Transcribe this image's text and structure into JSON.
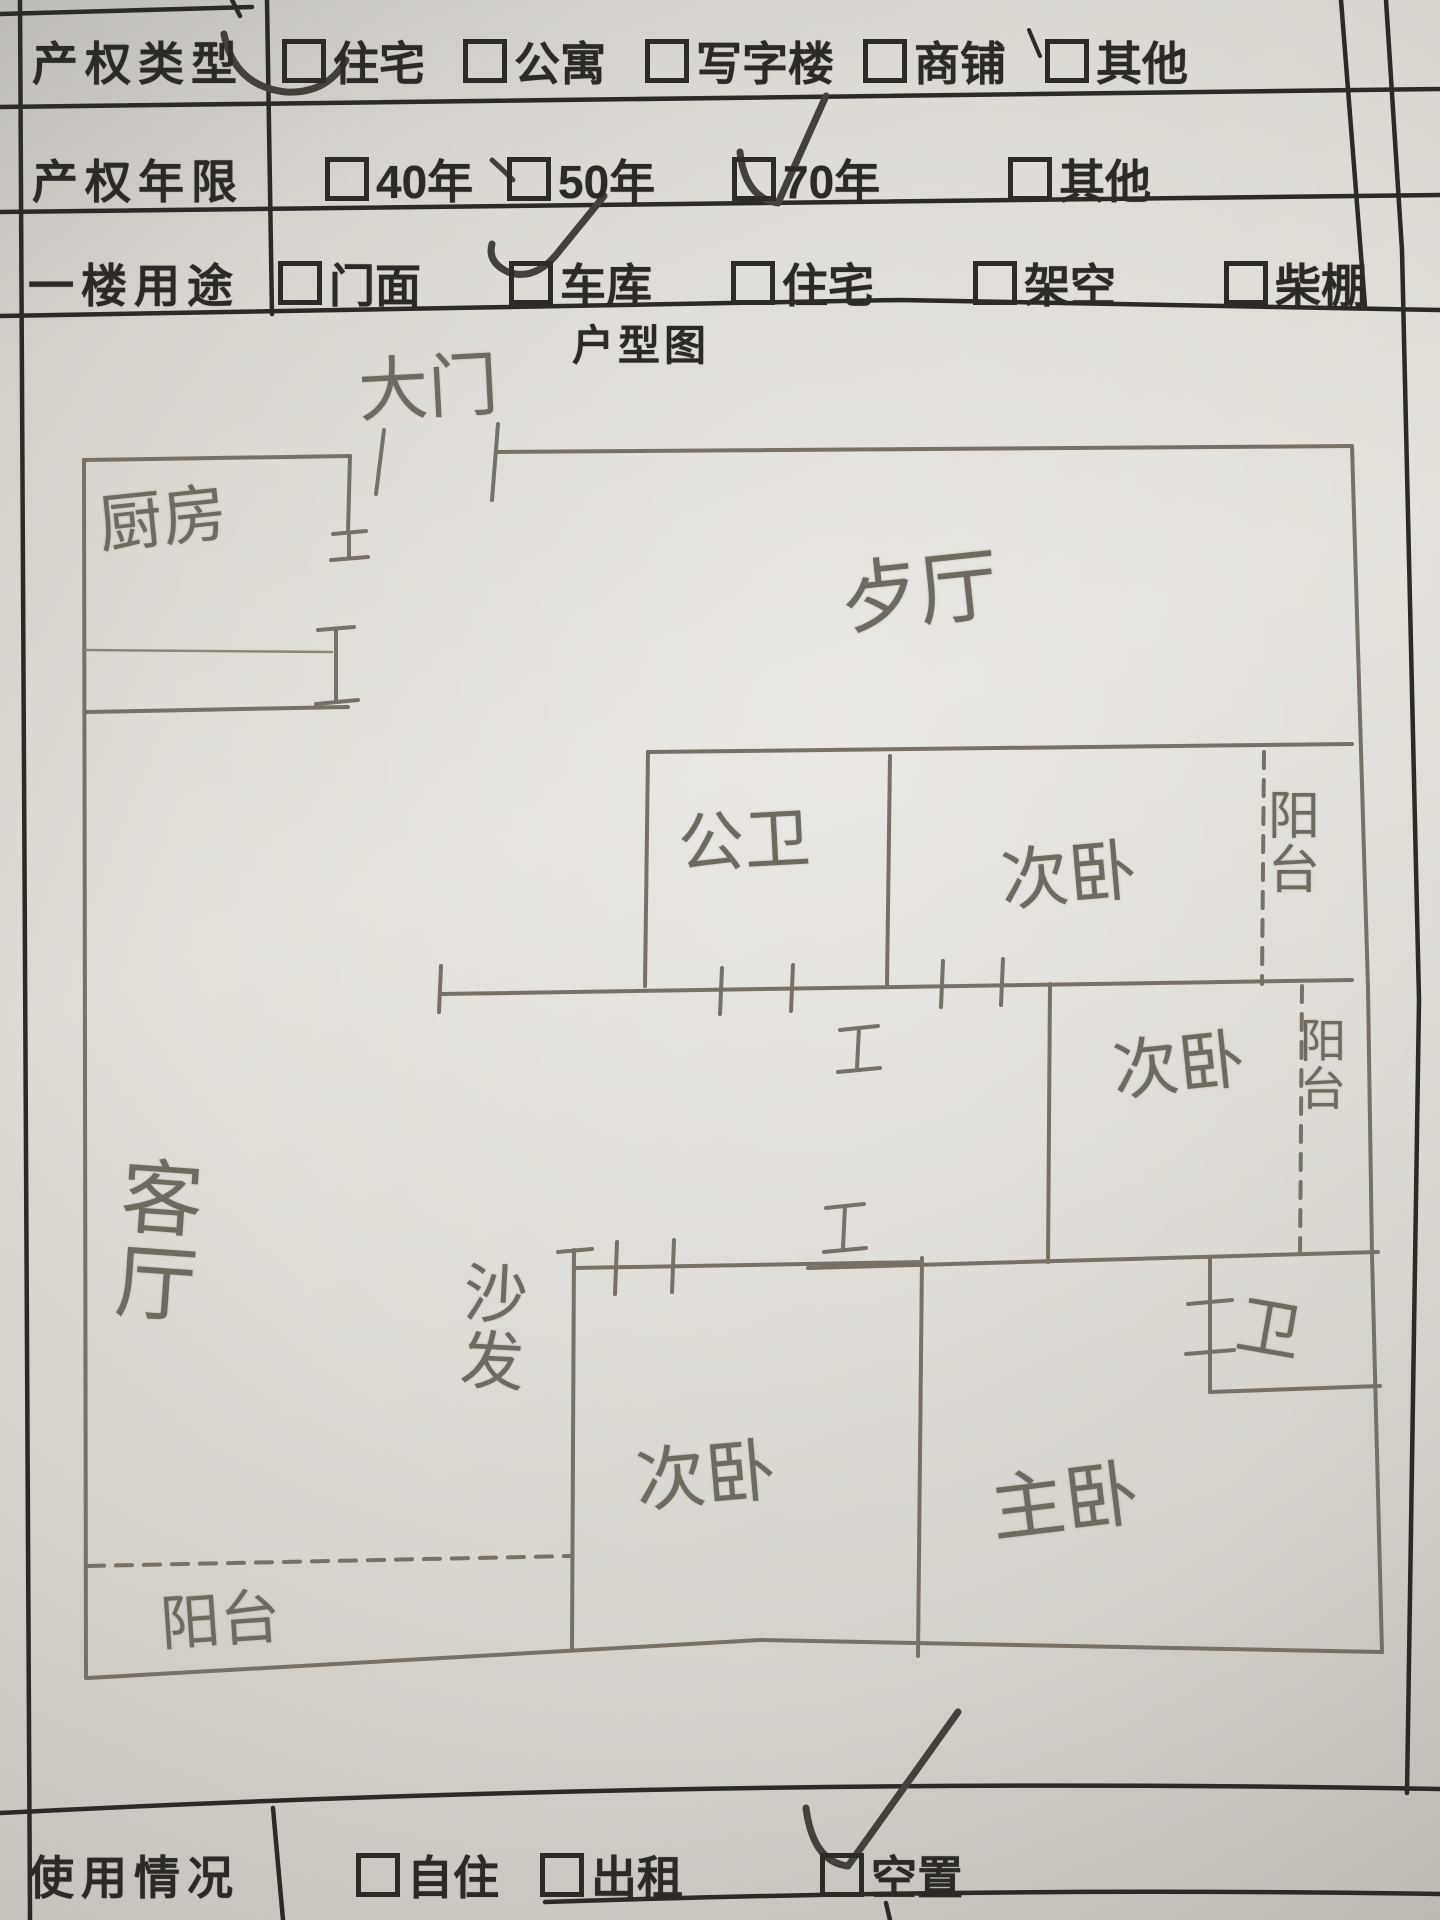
{
  "table": {
    "rows": [
      {
        "label": "产权类型",
        "options": [
          {
            "label": "住宅",
            "marked": true
          },
          {
            "label": "公寓",
            "marked": false
          },
          {
            "label": "写字楼",
            "marked": false
          },
          {
            "label": "商铺",
            "marked": false
          },
          {
            "label": "其他",
            "marked": false
          }
        ]
      },
      {
        "label": "产权年限",
        "options": [
          {
            "label": "40年",
            "marked": false
          },
          {
            "label": "50年",
            "marked": false
          },
          {
            "label": "70年",
            "marked": true
          },
          {
            "label": "其他",
            "marked": false
          }
        ]
      },
      {
        "label": "一楼用途",
        "options": [
          {
            "label": "门面",
            "marked": false
          },
          {
            "label": "车库",
            "marked": true
          },
          {
            "label": "住宅",
            "marked": false
          },
          {
            "label": "架空",
            "marked": false
          },
          {
            "label": "柴棚",
            "marked": false
          }
        ]
      },
      {
        "label": "使用情况",
        "options": [
          {
            "label": "自住",
            "marked": false
          },
          {
            "label": "出租",
            "marked": false
          },
          {
            "label": "空置",
            "marked": true
          }
        ]
      }
    ]
  },
  "floor_plan": {
    "title": "户型图",
    "rooms": {
      "entrance": "大门",
      "kitchen": "厨房",
      "dining": "歺厅",
      "public_bathroom": "公卫",
      "bedroom_top": "次卧",
      "balcony_top": "阳台",
      "bedroom_middle": "次卧",
      "balcony_middle": "阳台",
      "living_room": "客厅",
      "sofa": "沙发",
      "bedroom_bottom": "次卧",
      "master_bedroom": "主卧",
      "bathroom": "卫",
      "balcony_bottom": "阳台"
    }
  },
  "colors": {
    "ink": "#2c2a27",
    "pencil": "#767066",
    "pen": "#45403a",
    "paper": "#dedbd5"
  }
}
